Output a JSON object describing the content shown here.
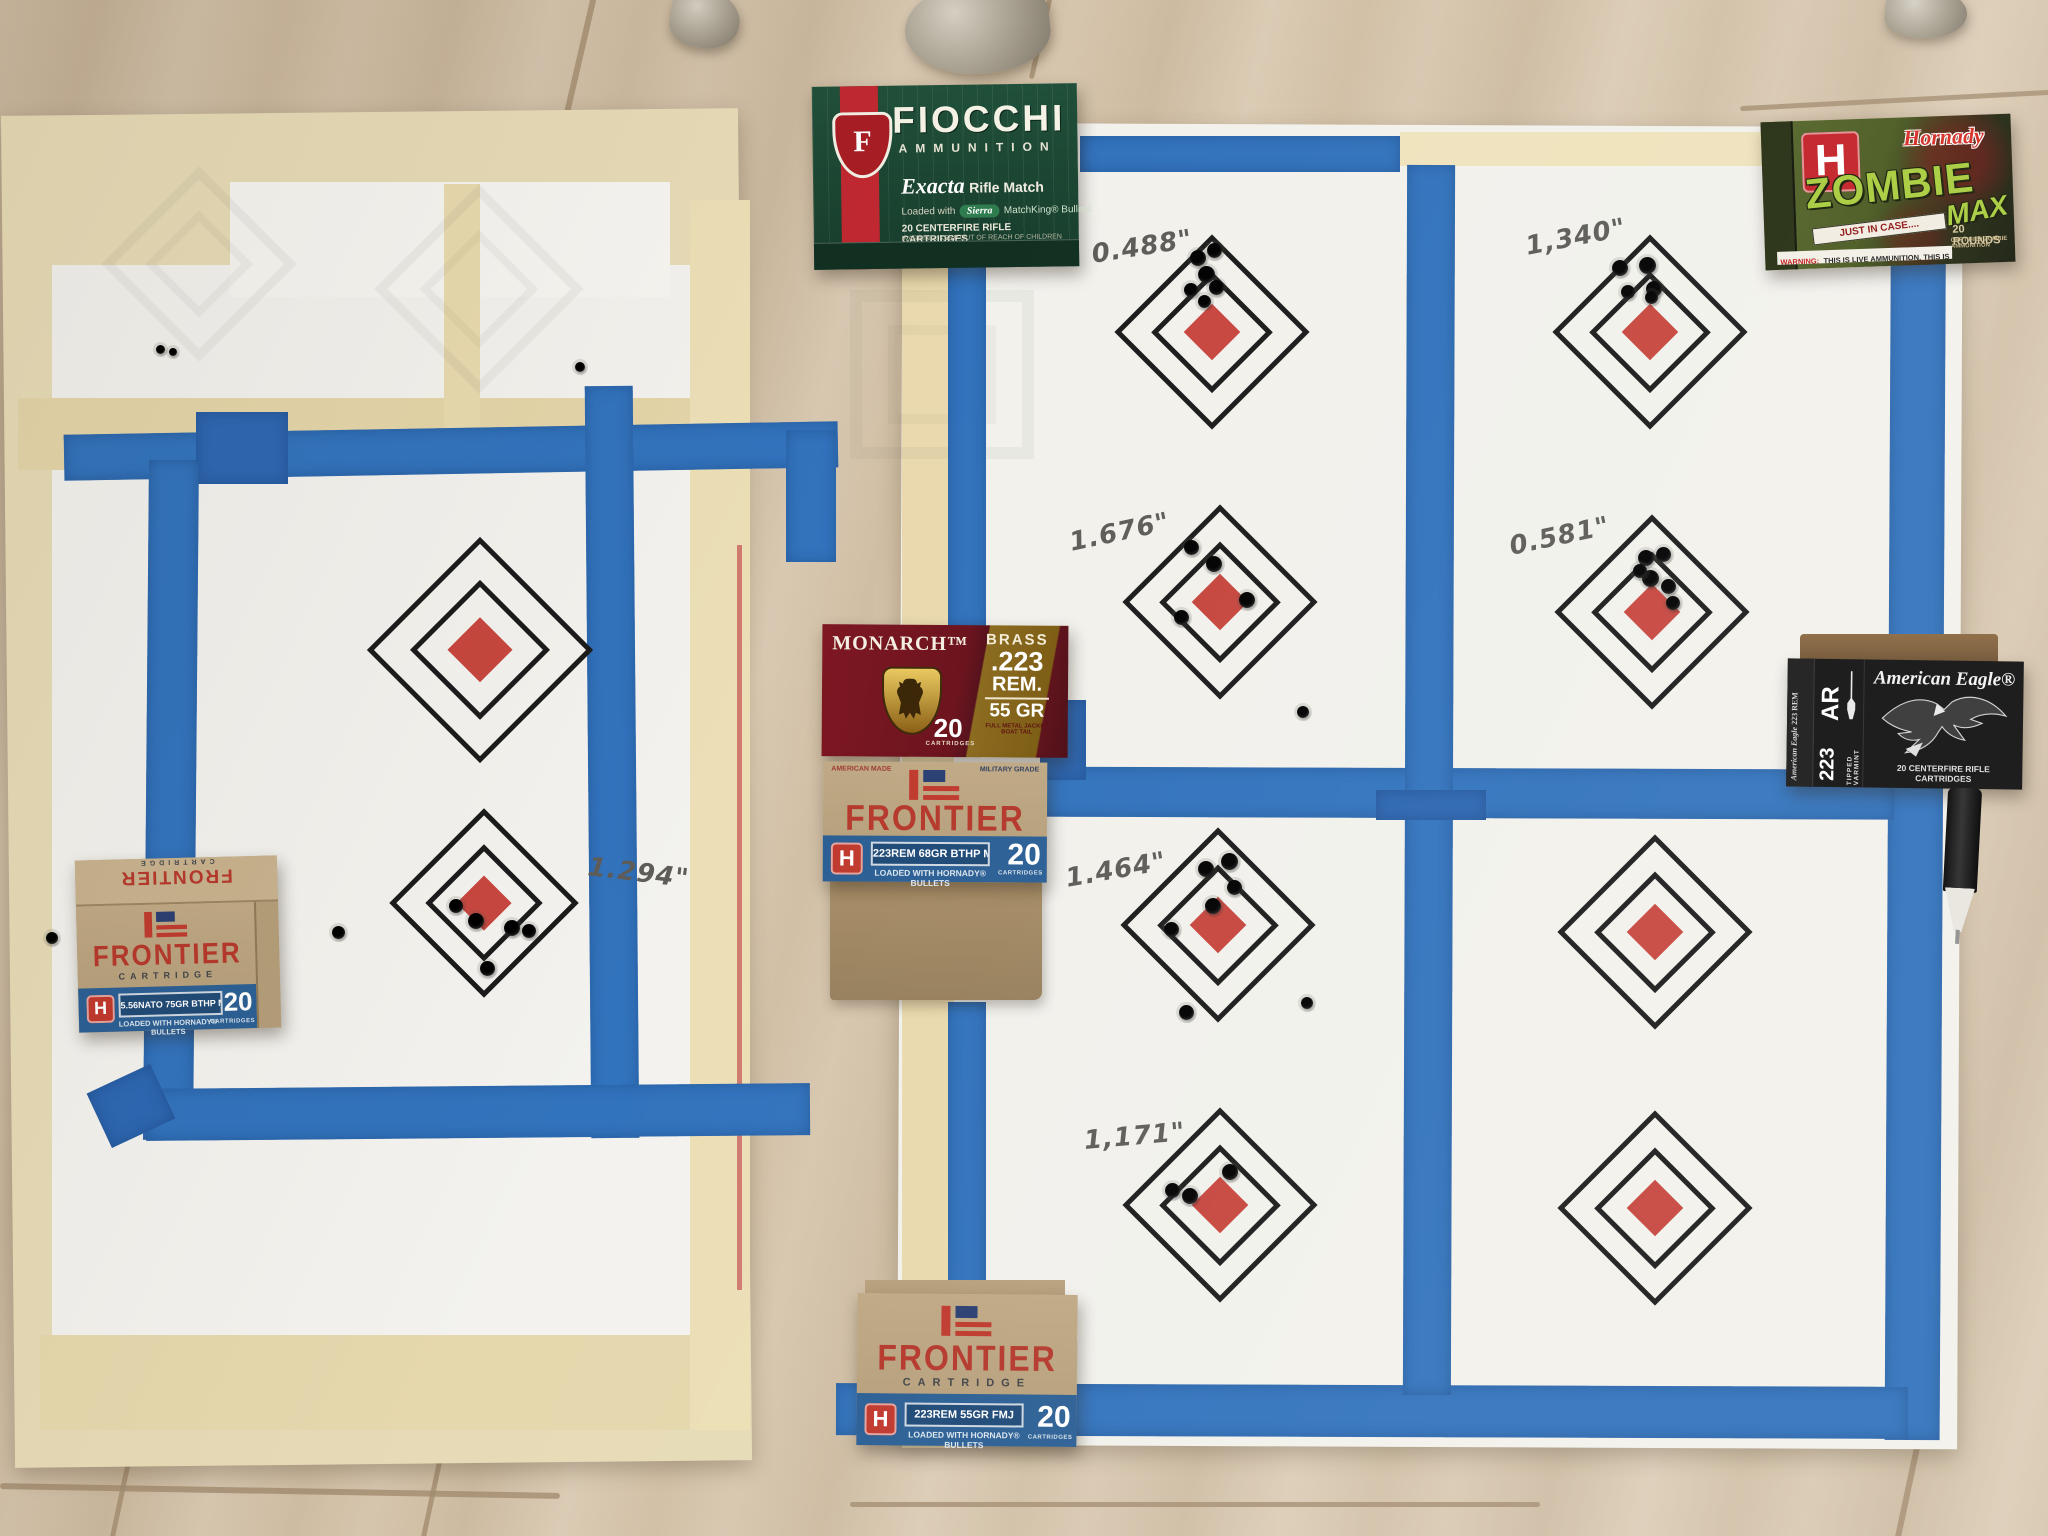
{
  "measurements": {
    "left_target": "1.294\"",
    "top_left": "0.488\"",
    "top_right": "1,340\"",
    "mid_left": "1.676\"",
    "mid_right": "0.581\"",
    "lower_left": "1.464\"",
    "bottom_left": "1,171\""
  },
  "boxes": {
    "fiocchi": {
      "brand": "FIOCCHI",
      "sub": "AMMUNITION",
      "exacta": "Exacta",
      "rifle_match": "Rifle Match",
      "loaded_prefix": "Loaded with",
      "sierra": "Sierra",
      "loaded_suffix": "MatchKing® Bullets",
      "cartridges": "20 CENTERFIRE RIFLE CARTRIDGES",
      "warning": "WARNING: KEEP OUT OF REACH OF CHILDREN",
      "monogram": "F"
    },
    "zombie": {
      "hornady": "Hornady",
      "h_logo": "H",
      "title": "ZOMBIE",
      "title2": "MAX",
      "banner": "JUST IN CASE....",
      "rounds": "20 ROUNDS",
      "certified": "CERTIFIED ZOMBIE AMMUNITION",
      "warning_label": "WARNING:",
      "warning_text": "THIS IS LIVE AMMUNITION. THIS IS NOT A TOY."
    },
    "monarch": {
      "brand": "MONARCH™",
      "count": "20",
      "count_label": "CARTRIDGES",
      "brass": "BRASS",
      "cal1": ".223",
      "cal2": "REM.",
      "grain": "55 GR",
      "bullet_type": "FULL METAL JACKET BOAT TAIL"
    },
    "frontier_mid": {
      "american_made": "AMERICAN MADE",
      "military_grade": "MILITARY GRADE",
      "brand": "FRONTIER",
      "cartridge": "CARTRIDGE",
      "spec": "223REM 68GR BTHP MATCH",
      "loaded": "LOADED WITH HORNADY® BULLETS",
      "count": "20",
      "count_label": "CARTRIDGES",
      "h_logo": "H"
    },
    "frontier_left": {
      "lid_sub": "CARTRIDGE",
      "lid_brand": "FRONTIER",
      "brand": "FRONTIER",
      "cartridge": "CARTRIDGE",
      "spec": "5.56NATO 75GR BTHP MATCH",
      "loaded": "LOADED WITH HORNADY® BULLETS",
      "count": "20",
      "count_label": "CARTRIDGES",
      "h_logo": "H"
    },
    "frontier_bottom": {
      "brand": "FRONTIER",
      "cartridge": "CARTRIDGE",
      "spec": "223REM 55GR FMJ",
      "loaded": "LOADED WITH HORNADY® BULLETS",
      "count": "20",
      "count_label": "CARTRIDGES",
      "h_logo": "H"
    },
    "american_eagle": {
      "brand": "American Eagle®",
      "ar": "AR",
      "cal": "223",
      "tipped": "TIPPED VARMINT",
      "cartridges": "20 CENTERFIRE RIFLE CARTRIDGES",
      "side1": "American Eagle",
      "side2": "223 REM"
    }
  },
  "colors": {
    "painters_tape": "#3273bd",
    "target_red": "#c6463e",
    "paper_white": "#f3f2ee",
    "manila_tape": "#e8daae",
    "floor_wood": "#d4c3ab"
  },
  "bullet_holes": [
    [
      1198,
      258,
      16
    ],
    [
      1214,
      250,
      15
    ],
    [
      1206,
      274,
      17
    ],
    [
      1191,
      290,
      14
    ],
    [
      1216,
      287,
      15
    ],
    [
      1204,
      301,
      13
    ],
    [
      1620,
      268,
      16
    ],
    [
      1647,
      265,
      17
    ],
    [
      1654,
      289,
      16
    ],
    [
      1628,
      292,
      14
    ],
    [
      1651,
      297,
      13
    ],
    [
      1191,
      547,
      15
    ],
    [
      1214,
      564,
      16
    ],
    [
      1247,
      600,
      16
    ],
    [
      1181,
      617,
      15
    ],
    [
      1646,
      558,
      16
    ],
    [
      1663,
      554,
      15
    ],
    [
      1650,
      578,
      17
    ],
    [
      1668,
      586,
      15
    ],
    [
      1640,
      571,
      14
    ],
    [
      1673,
      603,
      14
    ],
    [
      1206,
      869,
      16
    ],
    [
      1229,
      861,
      17
    ],
    [
      1234,
      887,
      15
    ],
    [
      1171,
      929,
      15
    ],
    [
      1213,
      906,
      16
    ],
    [
      1186,
      1012,
      15
    ],
    [
      1230,
      1172,
      16
    ],
    [
      1172,
      1190,
      15
    ],
    [
      1190,
      1196,
      16
    ],
    [
      456,
      906,
      14
    ],
    [
      476,
      921,
      16
    ],
    [
      512,
      928,
      16
    ],
    [
      529,
      931,
      14
    ],
    [
      487,
      968,
      15
    ],
    [
      160,
      349,
      9
    ],
    [
      173,
      352,
      8
    ],
    [
      580,
      367,
      10
    ],
    [
      52,
      938,
      12
    ],
    [
      338,
      932,
      13
    ],
    [
      1303,
      712,
      12
    ],
    [
      1307,
      1003,
      12
    ]
  ]
}
